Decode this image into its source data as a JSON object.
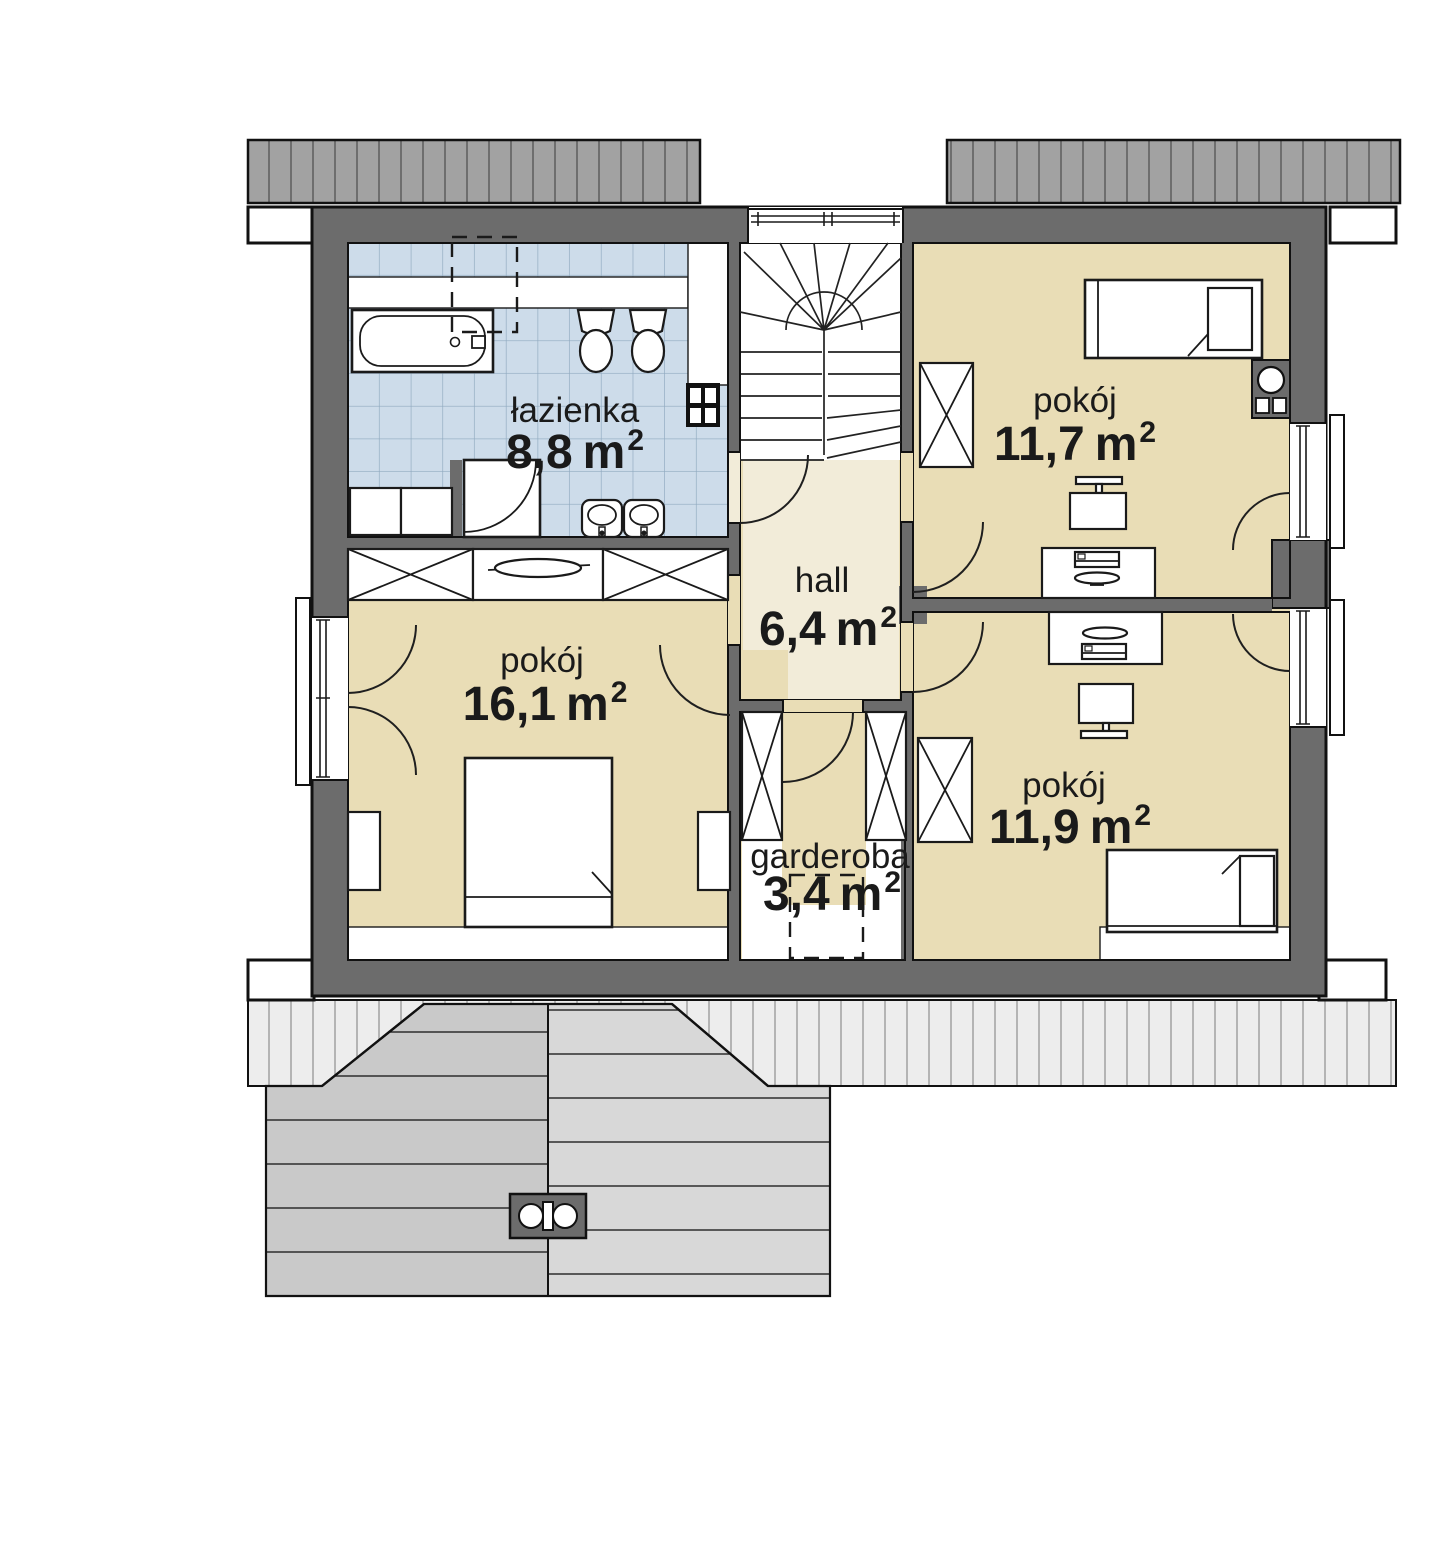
{
  "plan_title": "floor plan - upper storey",
  "rooms": {
    "lazienka": {
      "name": "łazienka",
      "area_value": "8,8",
      "area_unit": "m",
      "area_sup": "2"
    },
    "pokoj_gorny": {
      "name": "pokój",
      "area_value": "11,7",
      "area_unit": "m",
      "area_sup": "2"
    },
    "hall": {
      "name": "hall",
      "area_value": "6,4",
      "area_unit": "m",
      "area_sup": "2"
    },
    "pokoj_lewy": {
      "name": "pokój",
      "area_value": "16,1",
      "area_unit": "m",
      "area_sup": "2"
    },
    "pokoj_dolny": {
      "name": "pokój",
      "area_value": "11,9",
      "area_unit": "m",
      "area_sup": "2"
    },
    "garderoba": {
      "name": "garderoba",
      "area_value": "3,4",
      "area_unit": "m",
      "area_sup": "2"
    }
  },
  "colors": {
    "wall": "#6c6c6c",
    "outline": "#111111",
    "room": "#e9ddb6",
    "hall": "#f2ecd9",
    "tile": "#cddcea",
    "tile_line": "#8fa9bf",
    "roof_top": "#a2a2a2",
    "roof_top_line": "#6e6e6e",
    "eaves": "#ededed",
    "eaves_line": "#a6a6a6",
    "roof_left": "#c9c9c9",
    "roof_right": "#d8d8d8",
    "text": "#1a1a1a"
  }
}
